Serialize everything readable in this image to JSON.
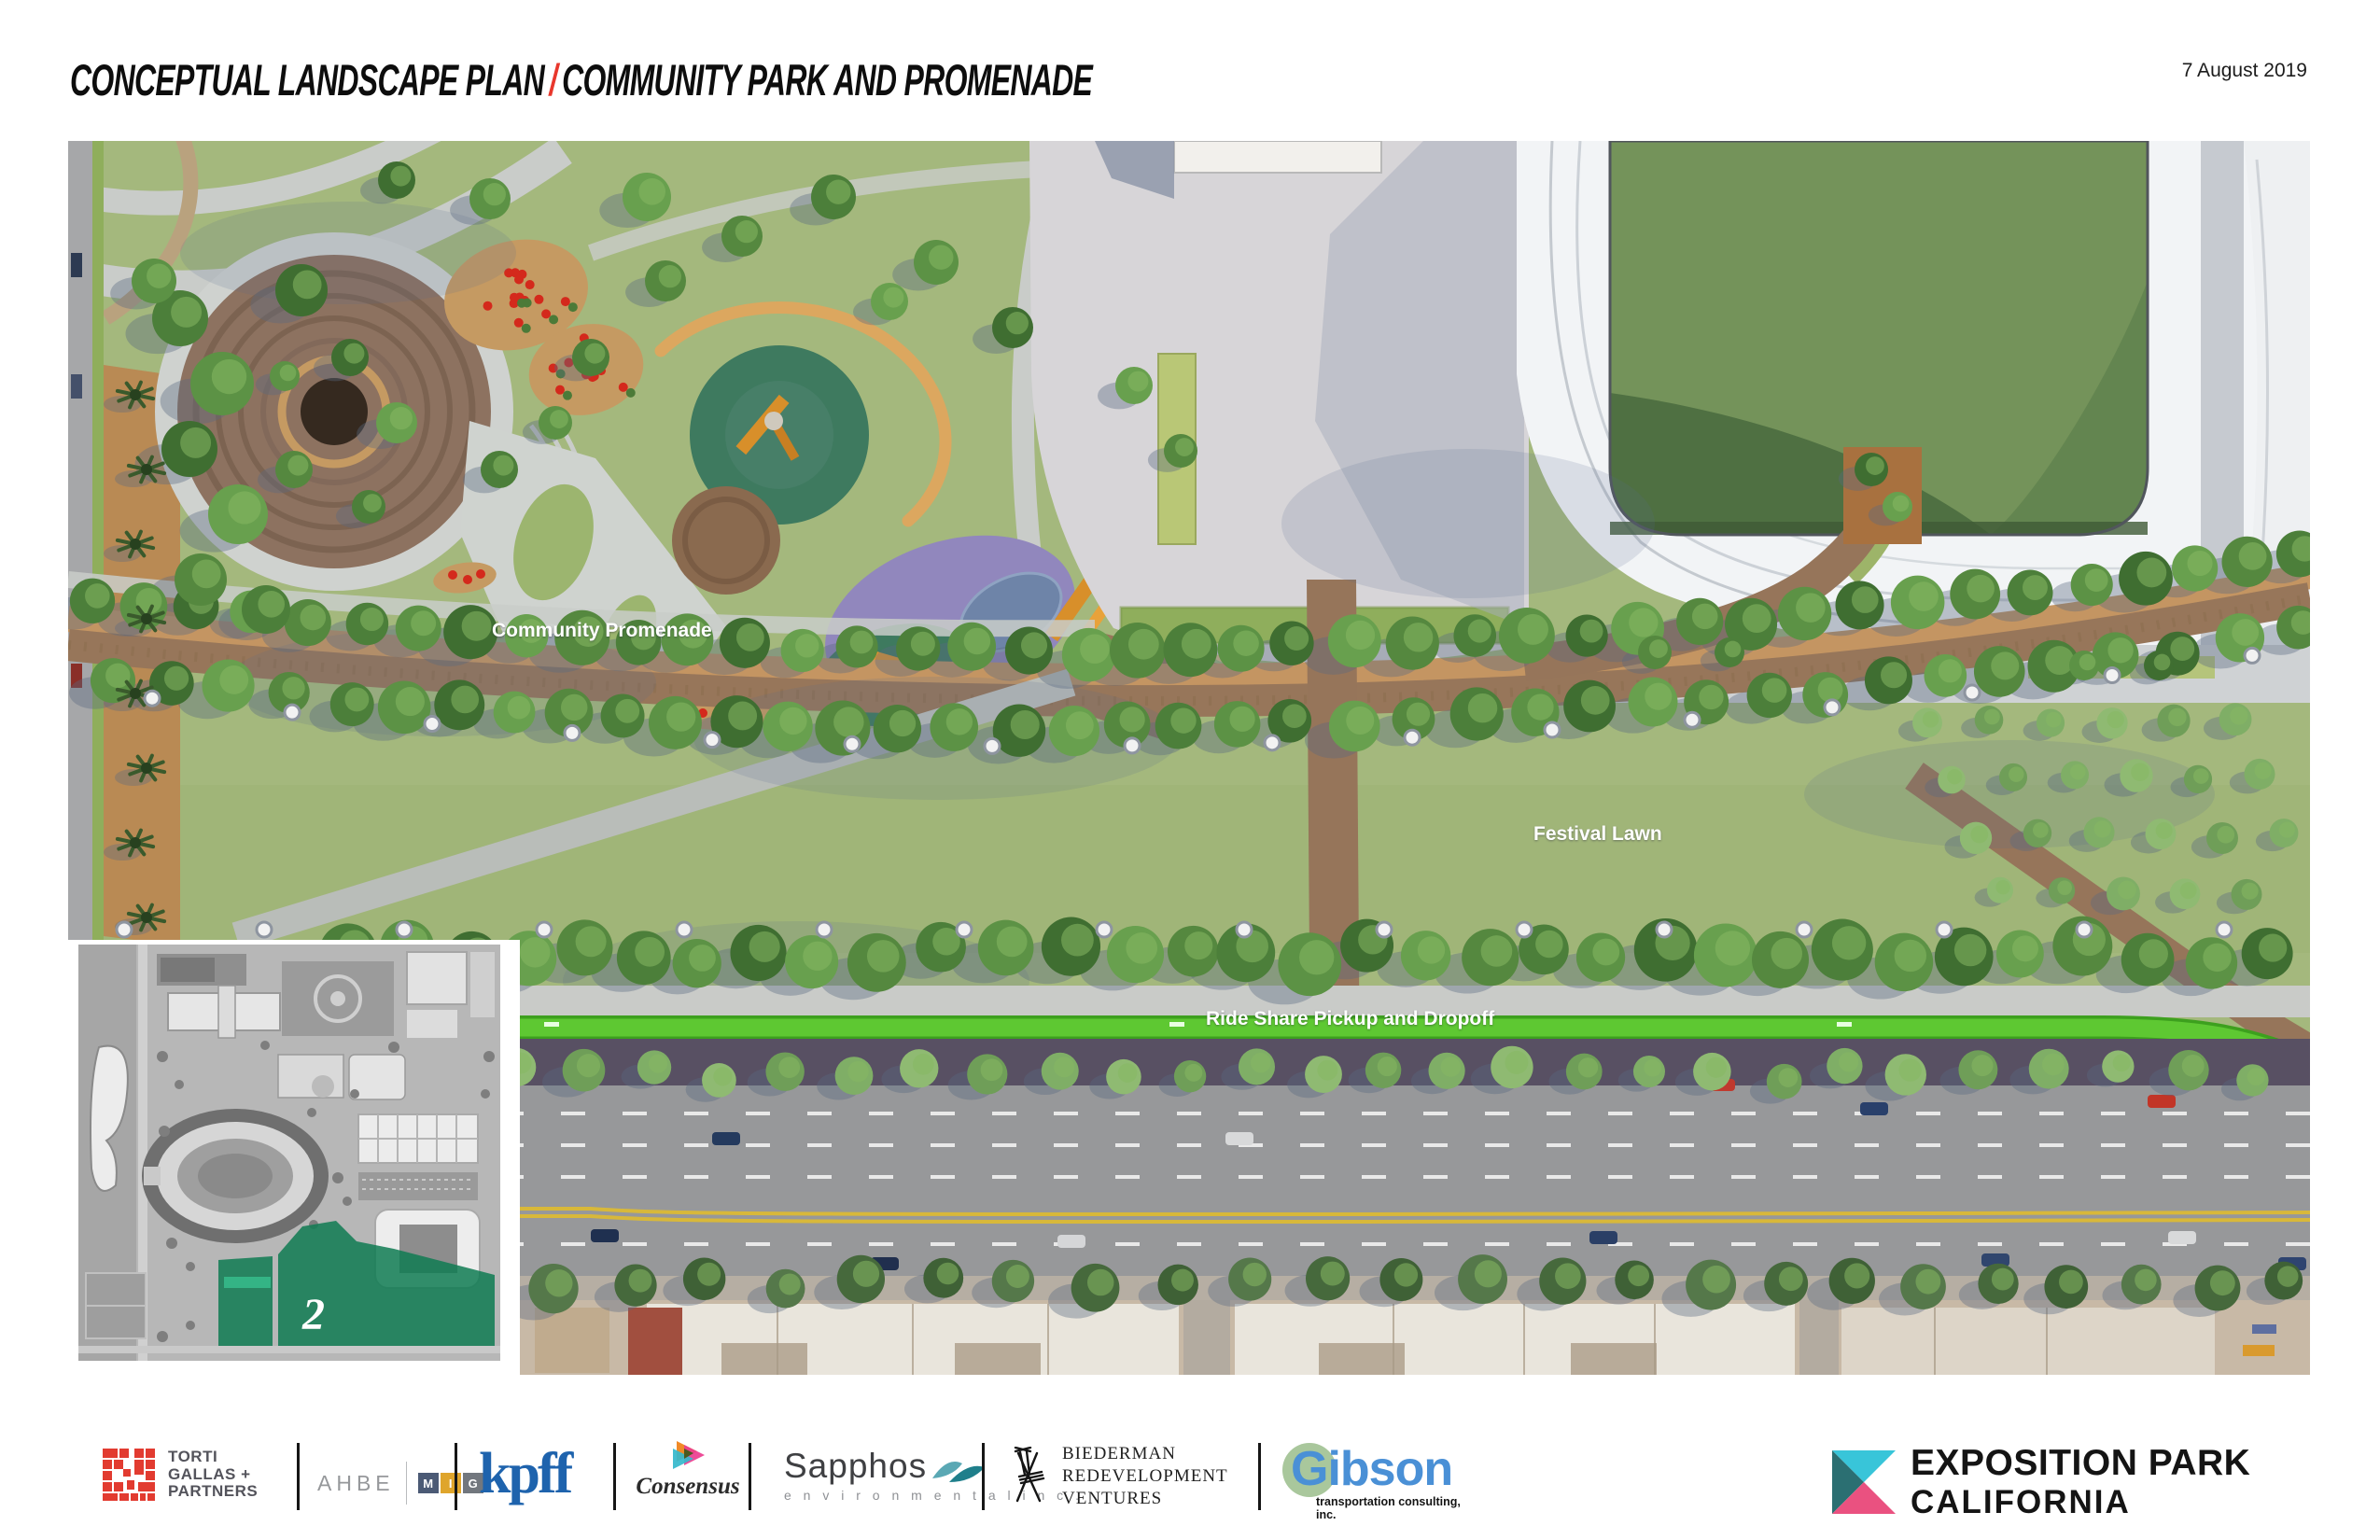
{
  "header": {
    "title_left": "CONCEPTUAL LANDSCAPE PLAN",
    "title_separator": "/",
    "title_right": "COMMUNITY PARK AND PROMENADE",
    "date": "7 August 2019"
  },
  "plan": {
    "labels": {
      "promenade": "Community Promenade",
      "lawn": "Festival Lawn",
      "rideshare": "Ride Share Pickup and Dropoff"
    }
  },
  "inset": {
    "area_number": "2"
  },
  "footer": {
    "torti": {
      "lines": [
        "TORTI",
        "GALLAS +",
        "PARTNERS"
      ]
    },
    "ahbe": {
      "text": "AHBE"
    },
    "mig": {
      "letters": [
        "M",
        "I",
        "G"
      ]
    },
    "kpff": {
      "text": "kpff"
    },
    "consensus": {
      "text": "Consensus"
    },
    "sapphos": {
      "name": "Sapphos",
      "sub": "e n v i r o n m e n t a l   i n c ."
    },
    "biederman": {
      "lines": [
        "BIEDERMAN",
        "REDEVELOPMENT",
        "VENTURES"
      ]
    },
    "gibson": {
      "name": "Gibson",
      "sub": "transportation consulting, inc."
    },
    "exposition": {
      "line1": "EXPOSITION PARK",
      "line2": "CALIFORNIA"
    }
  },
  "palette": {
    "accent_red": "#e8372c",
    "lawn_green": "#a4b87d",
    "promenade_brown": "#9b7a57",
    "bike_lane_green": "#5ec832",
    "rideshare_strip": "#5e5669",
    "stadium_roof": "#f2f4f6",
    "field_green": "#74935a",
    "inset_highlight": "#0f7b52",
    "torti_red": "#e23b30",
    "mig_navy": "#4b5a75",
    "mig_gold": "#dfa52c",
    "mig_gray": "#72777e",
    "kpff_blue": "#1e63ad",
    "consensus_orange": "#f08a28",
    "consensus_pink": "#ec3d8f",
    "consensus_teal": "#35b8cc",
    "sapphos_teal": "#1f7f8b",
    "gibson_blue": "#4a90d6",
    "gibson_green": "#a9c79c",
    "expo_cyan": "#38c5d9",
    "expo_teal": "#2b6f72",
    "expo_pink": "#ea5180"
  }
}
